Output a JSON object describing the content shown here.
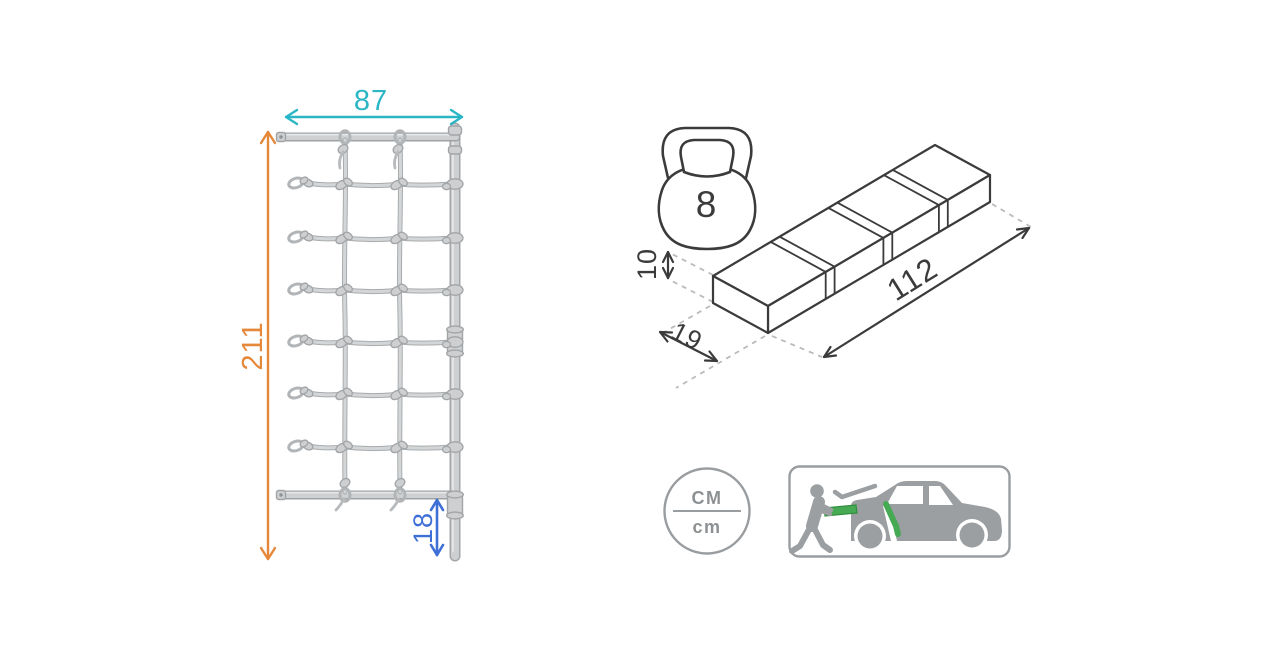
{
  "diagram": {
    "net": {
      "width_cm": "87",
      "height_cm": "211",
      "ground_clearance_cm": "18"
    },
    "package": {
      "weight_kg": "8",
      "height_cm": "10",
      "depth_cm": "19",
      "length_cm": "112"
    },
    "units_badge": {
      "top": "CM",
      "bottom": "cm"
    },
    "icons": {
      "weight": "kettlebell-icon",
      "units": "cm-units-circle-icon",
      "transport": "car-trunk-loading-icon"
    },
    "colors": {
      "width_dimension": "#2ab6c5",
      "height_dimension": "#e5883a",
      "clearance_dimension": "#3e6fd6",
      "outline_dark": "#3b3b3b",
      "icon_gray": "#9b9fa1",
      "accent_green": "#46aa55",
      "net_gray": "#cdcfd1"
    }
  }
}
